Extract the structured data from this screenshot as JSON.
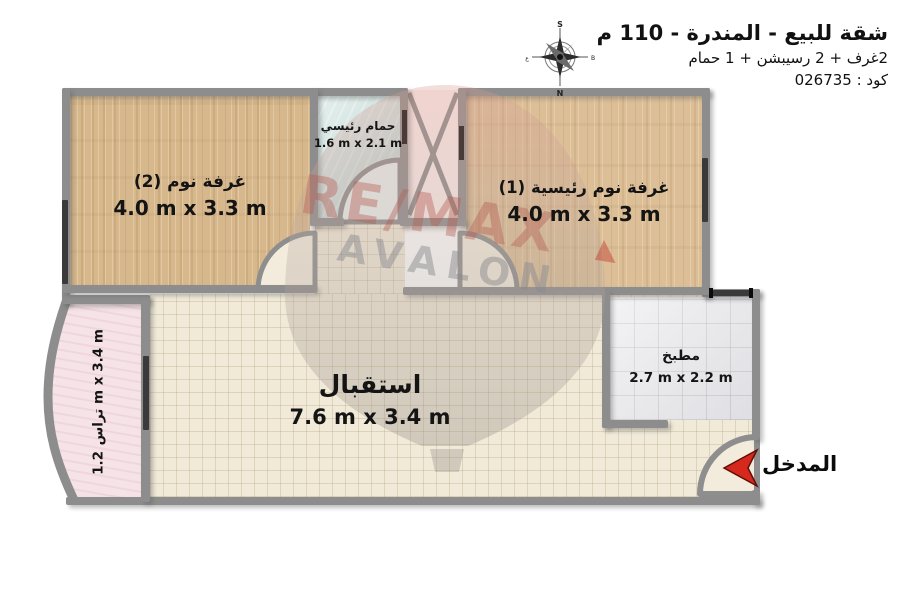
{
  "header": {
    "title": "شقة للبيع - المندرة - 110 م",
    "subtitle": "2غرف + 2 رسيبشن + 1 حمام",
    "code": "كود : 026735"
  },
  "compass": {
    "top": "S",
    "bottom": "N",
    "left": "ع",
    "right": "B"
  },
  "rooms": {
    "bedroom2": {
      "name": "غرفة نوم (2)",
      "dims": "4.0 m x 3.3 m"
    },
    "master_bedroom": {
      "name": "غرفة نوم رئيسية (1)",
      "dims": "4.0 m x 3.3 m"
    },
    "bathroom": {
      "name": "حمام رئيسي",
      "dims": "1.6 m x 2.1 m"
    },
    "reception": {
      "name": "استقبال",
      "dims": "7.6 m x 3.4 m"
    },
    "kitchen": {
      "name": "مطبخ",
      "dims": "2.7 m x 2.2 m"
    },
    "terrace": {
      "name": "تراس",
      "dims": "1.2 m x 3.4 m"
    }
  },
  "entrance": {
    "label": "المدخل"
  },
  "watermark": {
    "line1": "RE/MAX",
    "line2": "AVALON"
  },
  "colors": {
    "wall": "#8d8d8d",
    "wood_floor": "#d7b88c",
    "tile_floor": "#f1ead9",
    "kitchen_floor": "#e7e7ea",
    "bathroom_floor": "#cfe2df",
    "terrace_floor": "#f6e3e8",
    "entrance_arrow": "#d6281c",
    "text": "#141414"
  }
}
